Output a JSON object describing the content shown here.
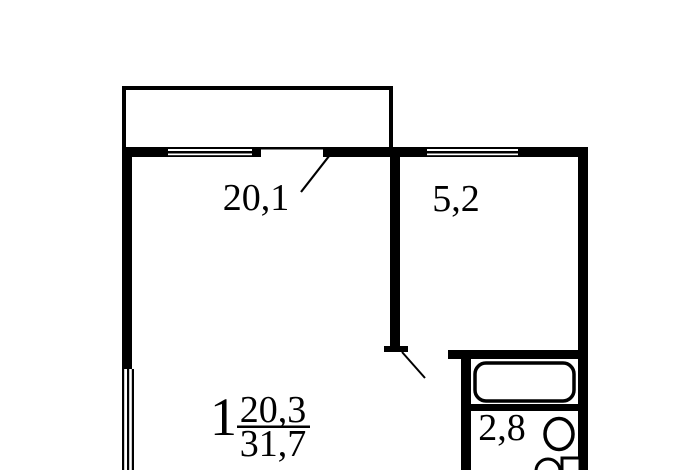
{
  "floor_plan": {
    "rooms": [
      {
        "id": "living-room",
        "area_label": "20,1"
      },
      {
        "id": "kitchen",
        "area_label": "5,2"
      },
      {
        "id": "bathroom",
        "area_label": "2,8"
      }
    ],
    "apartment_stamp": {
      "rooms_count": "1",
      "living_area": "20,3",
      "total_area": "31,7"
    },
    "fixtures": [
      {
        "icon": "bathtub-icon"
      },
      {
        "icon": "washbasin-icon"
      },
      {
        "icon": "toilet-icon"
      }
    ],
    "colors": {
      "wall": "#000000",
      "background": "#ffffff"
    }
  }
}
